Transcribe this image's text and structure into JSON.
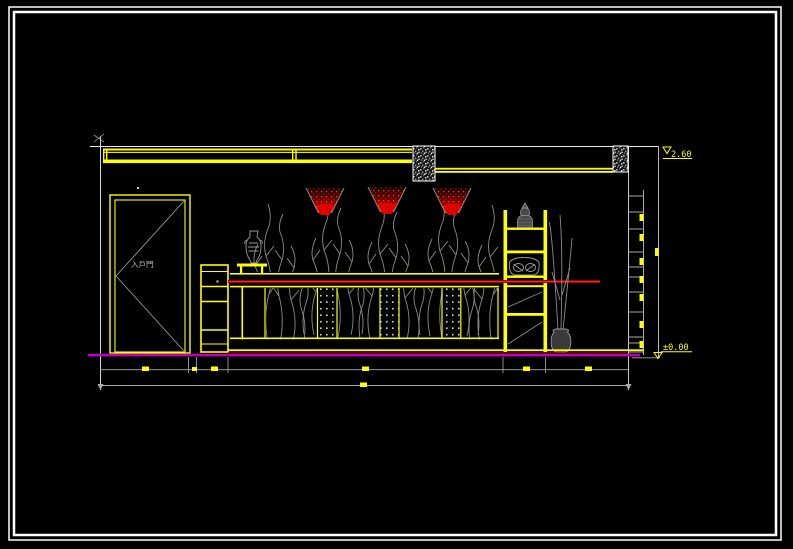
{
  "app": {
    "type": "cad-drawing-viewer",
    "description": "AutoCAD style interior elevation drawing: entry door, decorative counter with perforated panels, plant branches, three red spotlights, display shelf with Buddha statue and fish bowl, floor vase, dimension chains"
  },
  "drawing": {
    "door_label": "入戶門",
    "elevation_top_label": "2.60",
    "elevation_floor_label": "±0.00"
  },
  "colors": {
    "background": "#000000",
    "frame_white": "#ffffff",
    "line_yellow": "#ffff00",
    "line_gray": "#8c8c8c",
    "accent_red": "#e01000",
    "floor_magenta": "#c000c0"
  }
}
